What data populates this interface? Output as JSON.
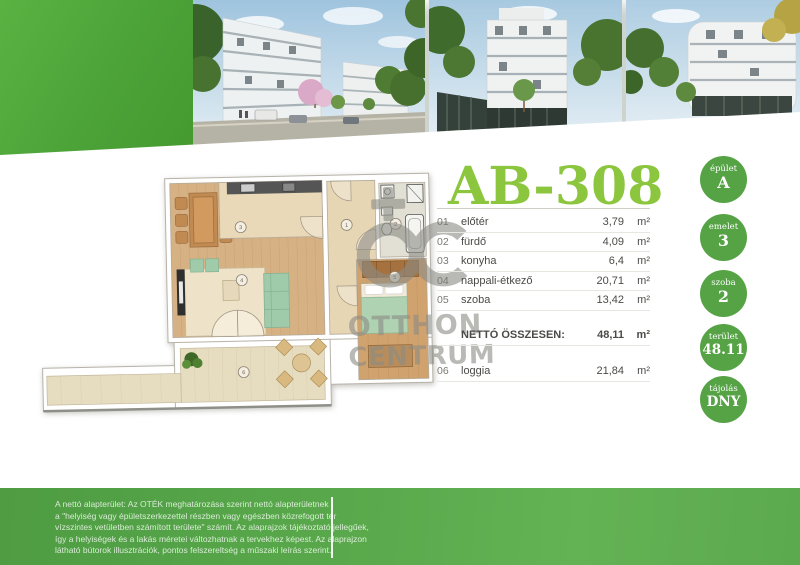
{
  "header": {
    "title": "AB-308"
  },
  "photos": [
    {
      "name": "street view render with apartment buildings and cherry blossoms"
    },
    {
      "name": "white apartment building render with trees"
    },
    {
      "name": "rounded corner building render with autumn tree"
    }
  ],
  "rooms": {
    "items": [
      {
        "no": "01",
        "name": "előtér",
        "value": "3,79",
        "unit": "m²"
      },
      {
        "no": "02",
        "name": "fürdő",
        "value": "4,09",
        "unit": "m²"
      },
      {
        "no": "03",
        "name": "konyha",
        "value": "6,4",
        "unit": "m²"
      },
      {
        "no": "04",
        "name": "nappali-étkező",
        "value": "20,71",
        "unit": "m²"
      },
      {
        "no": "05",
        "name": "szoba",
        "value": "13,42",
        "unit": "m²"
      }
    ],
    "total": {
      "label": "NETTÓ ÖSSZESEN:",
      "value": "48,11",
      "unit": "m²"
    },
    "extra": {
      "no": "06",
      "name": "loggia",
      "value": "21,84",
      "unit": "m²"
    }
  },
  "badges": [
    {
      "label": "épület",
      "value": "A"
    },
    {
      "label": "emelet",
      "value": "3"
    },
    {
      "label": "szoba",
      "value": "2"
    },
    {
      "label": "terület",
      "value": "48.11"
    },
    {
      "label": "tájolás",
      "value": "DNY"
    }
  ],
  "plan": {
    "markers": {
      "eloter": "1",
      "furdo": "2",
      "konyha": "3",
      "nappali": "4",
      "szoba": "5",
      "loggia": "6"
    }
  },
  "watermark": {
    "line1": "OTTHON",
    "line2": "CENTRUM"
  },
  "footer": {
    "lines": [
      "A nettó alapterület: Az OTÉK meghatározása szerint nettó alapterületnek",
      "a \"helyiség vagy épületszerkezettel részben vagy egészben közrefogott tér",
      "vízszintes vetületben számított területe\" számít. Az alaprajzok tájékoztató jellegűek,",
      "így a helyiségek és a lakás méretei változhatnak a tervekhez képest. Az alaprajzon",
      "látható bútorok illusztrációk, pontos felszereltség a műszaki leírás szerint."
    ]
  },
  "colors": {
    "title_green": "#8cc63e",
    "badge_green": "#55a345",
    "footer_green": "#58a84b",
    "wedge_green": "#4ca338"
  }
}
